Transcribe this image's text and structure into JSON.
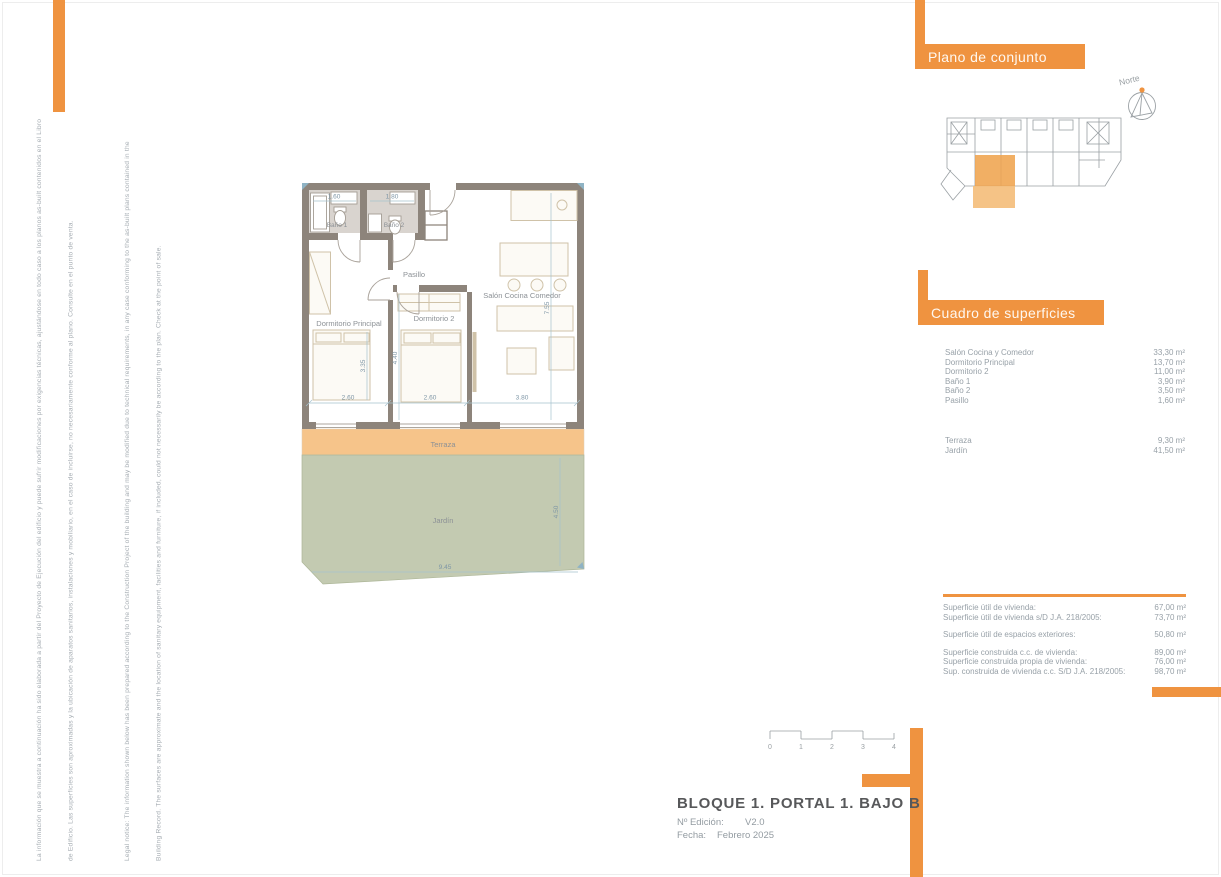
{
  "colors": {
    "accent": "#EF9340",
    "terraza_fill": "#F6C48A",
    "jardin_fill": "#C3CAB1",
    "wall": "#8D847B"
  },
  "legal": {
    "es_line1": "La información que se muestra a continuación ha sido elaborada a partir del Proyecto de Ejecución del edificio y puede sufrir modificaciones por exigencias técnicas, ajustándose en todo caso a los planos as-built contenidos en el Libro",
    "es_line2": "de Edificio. Las superficies son aproximadas y la ubicación de aparatos sanitarios, instalaciones y mobiliario, en el caso de incluirse, no necesariamente conforme al plano. Consulte en el punto de venta.",
    "en_line1": "Legal notice: The information shown below has been prepared according to the Construction Project of the building and may be modified due to technical requirements, in any case conforming to the as-built plans contained in the",
    "en_line2": "Building Record. The surfaces are approximate and the location of sanitary equipment, facilities and furniture, if included, could not necessarily be according to the plan. Check at the point of sale."
  },
  "overview": {
    "title": "Plano de conjunto",
    "north_label": "Norte"
  },
  "surfaces": {
    "title": "Cuadro de superficies",
    "rooms": [
      {
        "label": "Salón Cocina y Comedor",
        "value": "33,30 m²"
      },
      {
        "label": "Dormitorio Principal",
        "value": "13,70 m²"
      },
      {
        "label": "Dormitorio 2",
        "value": "11,00 m²"
      },
      {
        "label": "Baño 1",
        "value": "3,90 m²"
      },
      {
        "label": "Baño 2",
        "value": "3,50 m²"
      },
      {
        "label": "Pasillo",
        "value": "1,60 m²"
      }
    ],
    "exterior": [
      {
        "label": "Terraza",
        "value": "9,30 m²"
      },
      {
        "label": "Jardín",
        "value": "41,50 m²"
      }
    ],
    "totals_group1": [
      {
        "label": "Superficie útil de vivienda:",
        "value": "67,00 m²"
      },
      {
        "label": "Superficie útil de vivienda s/D J.A. 218/2005:",
        "value": "73,70 m²"
      }
    ],
    "totals_group2": [
      {
        "label": "Superficie útil de espacios exteriores:",
        "value": "50,80 m²"
      }
    ],
    "totals_group3": [
      {
        "label": "Superficie construida c.c. de vivienda:",
        "value": "89,00 m²"
      },
      {
        "label": "Superficie construida propia de vivienda:",
        "value": "76,00 m²"
      },
      {
        "label": "Sup. construida de vivienda c.c. S/D J.A. 218/2005:",
        "value": "98,70 m²"
      }
    ]
  },
  "plan": {
    "room_labels": {
      "banio1": "Baño 1",
      "banio2": "Baño 2",
      "pasillo": "Pasillo",
      "salon": "Salón Cocina Comedor",
      "dorm_principal": "Dormitorio Principal",
      "dorm2": "Dormitorio 2",
      "terraza": "Terraza",
      "jardin": "Jardín"
    },
    "dimensions": {
      "banio1_w": "1.60",
      "banio2_w": "1.80",
      "dorm_principal_h": "3.35",
      "dorm2_h": "4.40",
      "salon_h": "7.55",
      "dorm_principal_w": "2.60",
      "dorm2_w": "2.60",
      "salon_w": "3.80",
      "jardin_w": "9.45",
      "jardin_h": "4.50"
    }
  },
  "scalebar": {
    "ticks": [
      "0",
      "1",
      "2",
      "3",
      "4"
    ]
  },
  "titleblock": {
    "title": "BLOQUE 1. PORTAL 1. BAJO B",
    "edition_label": "Nº Edición:",
    "edition_value": "V2.0",
    "date_label": "Fecha:",
    "date_value": "Febrero 2025"
  }
}
